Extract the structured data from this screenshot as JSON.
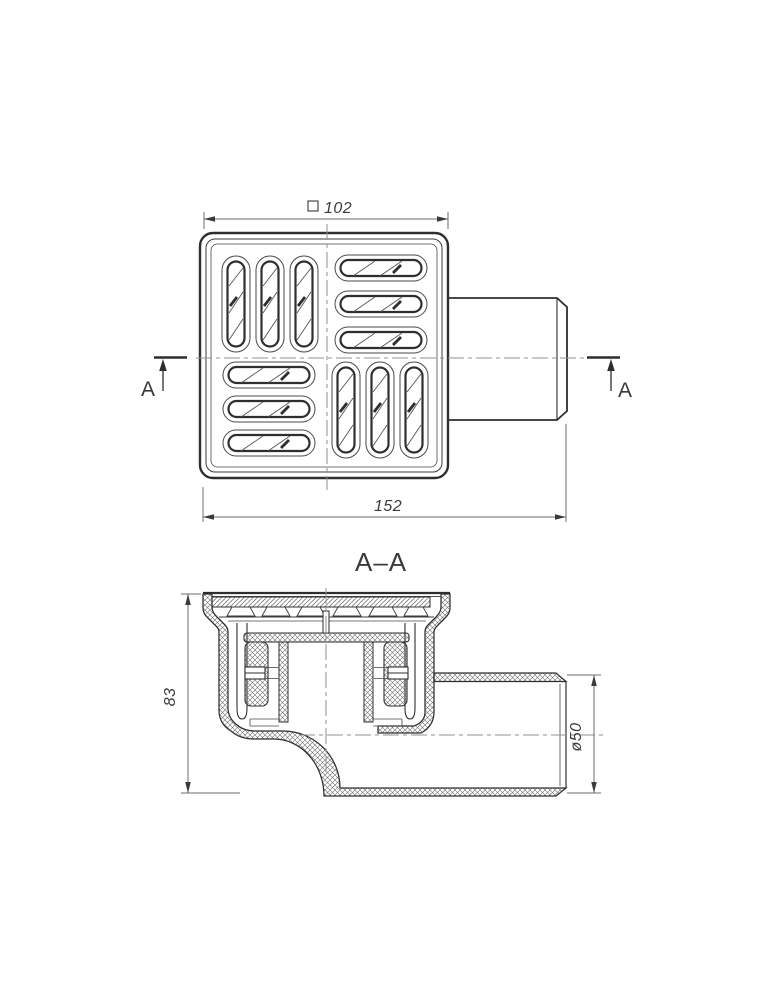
{
  "drawing": {
    "background": "#ffffff",
    "line_color": "#2e2e2e",
    "centerline_color": "#909090",
    "dim_color": "#6e6e6e",
    "text_color": "#3a3a3a",
    "top_view": {
      "width_dim": {
        "prefix": "□",
        "value": "102"
      },
      "length_dim": "152",
      "section_marker": "A"
    },
    "section_view": {
      "label": "A–A",
      "height_dim": "83",
      "pipe_diameter_dim": "ø50"
    }
  }
}
